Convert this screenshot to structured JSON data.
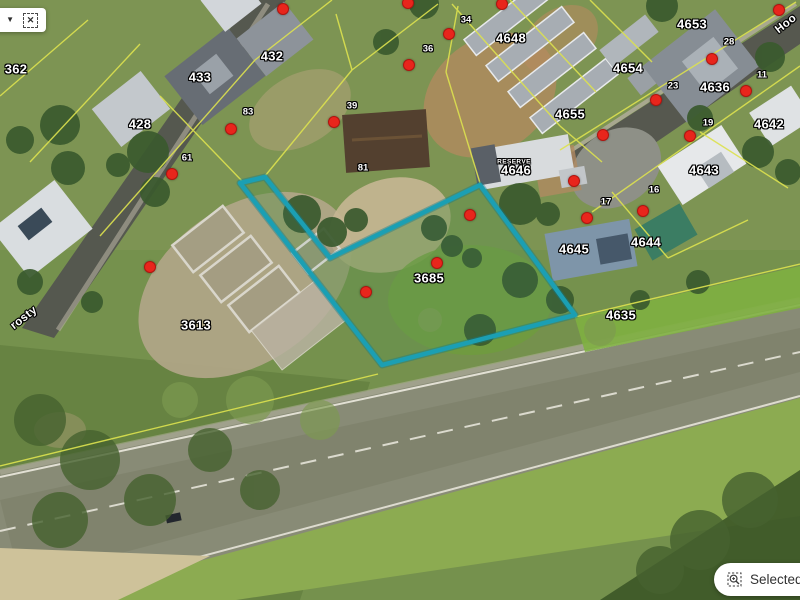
{
  "toolbar": {
    "icons": {
      "collapse_caret": "▼",
      "clear_selection": "✕",
      "zoom_to_selection": "magnifier-in-dashed-square"
    }
  },
  "status_pill": {
    "label": "Selected fe"
  },
  "map": {
    "colors": {
      "selection": "#1b9fb3",
      "selection_halo": "#0d7a8e",
      "cadastral": "#dde24f",
      "marker": "#e8251c",
      "label_text": "#ffffff"
    },
    "selection": {
      "points": "240,183 265,177 330,258 480,185 575,315 382,365"
    },
    "street_labels": [
      {
        "text": "rosty",
        "x": 24,
        "y": 318,
        "rot": -38
      },
      {
        "text": "Hoo",
        "x": 786,
        "y": 24,
        "rot": -38
      }
    ],
    "parcel_labels": [
      {
        "text": "362",
        "x": 16,
        "y": 69
      },
      {
        "text": "433",
        "x": 200,
        "y": 77
      },
      {
        "text": "432",
        "x": 272,
        "y": 56
      },
      {
        "text": "428",
        "x": 140,
        "y": 124
      },
      {
        "text": "4648",
        "x": 511,
        "y": 38
      },
      {
        "text": "4653",
        "x": 692,
        "y": 24
      },
      {
        "text": "4654",
        "x": 628,
        "y": 68
      },
      {
        "text": "4655",
        "x": 570,
        "y": 114
      },
      {
        "text": "4636",
        "x": 715,
        "y": 87
      },
      {
        "text": "4642",
        "x": 769,
        "y": 124
      },
      {
        "text": "4646",
        "x": 516,
        "y": 170
      },
      {
        "text": "4643",
        "x": 704,
        "y": 170
      },
      {
        "text": "4645",
        "x": 574,
        "y": 249
      },
      {
        "text": "4644",
        "x": 646,
        "y": 242
      },
      {
        "text": "4635",
        "x": 621,
        "y": 315
      },
      {
        "text": "3613",
        "x": 196,
        "y": 325
      },
      {
        "text": "3685",
        "x": 429,
        "y": 278
      }
    ],
    "address_labels": [
      {
        "text": "83",
        "x": 248,
        "y": 112
      },
      {
        "text": "61",
        "x": 187,
        "y": 158
      },
      {
        "text": "39",
        "x": 352,
        "y": 106
      },
      {
        "text": "81",
        "x": 363,
        "y": 168
      },
      {
        "text": "36",
        "x": 428,
        "y": 49
      },
      {
        "text": "34",
        "x": 466,
        "y": 20
      },
      {
        "text": "28",
        "x": 729,
        "y": 42
      },
      {
        "text": "23",
        "x": 673,
        "y": 86
      },
      {
        "text": "11",
        "x": 762,
        "y": 75
      },
      {
        "text": "19",
        "x": 708,
        "y": 123
      },
      {
        "text": "17",
        "x": 606,
        "y": 202
      },
      {
        "text": "16",
        "x": 654,
        "y": 190
      }
    ],
    "tiny_labels": [
      {
        "text": "RESERVE",
        "x": 514,
        "y": 162
      }
    ],
    "markers": [
      {
        "x": 283,
        "y": 9
      },
      {
        "x": 408,
        "y": 3
      },
      {
        "x": 502,
        "y": 4
      },
      {
        "x": 449,
        "y": 34
      },
      {
        "x": 409,
        "y": 65
      },
      {
        "x": 334,
        "y": 122
      },
      {
        "x": 231,
        "y": 129
      },
      {
        "x": 172,
        "y": 174
      },
      {
        "x": 150,
        "y": 267
      },
      {
        "x": 366,
        "y": 292
      },
      {
        "x": 437,
        "y": 263
      },
      {
        "x": 470,
        "y": 215
      },
      {
        "x": 574,
        "y": 181
      },
      {
        "x": 587,
        "y": 218
      },
      {
        "x": 643,
        "y": 211
      },
      {
        "x": 603,
        "y": 135
      },
      {
        "x": 712,
        "y": 59
      },
      {
        "x": 779,
        "y": 10
      },
      {
        "x": 746,
        "y": 91
      },
      {
        "x": 656,
        "y": 100
      },
      {
        "x": 690,
        "y": 136
      }
    ]
  }
}
